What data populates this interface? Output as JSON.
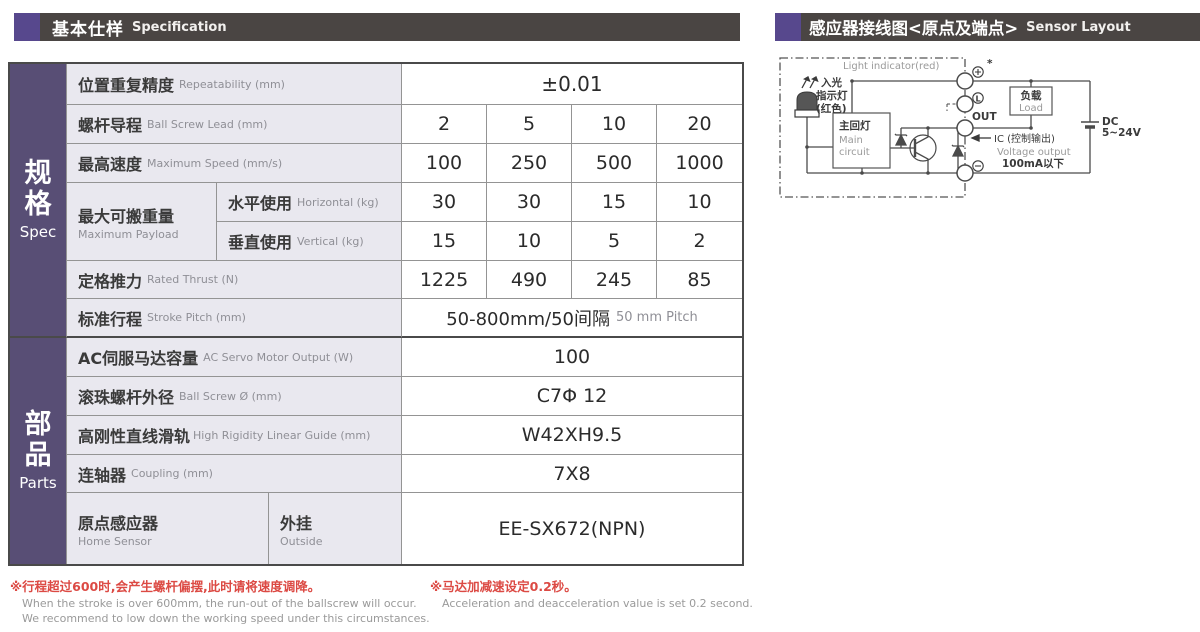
{
  "headers": {
    "left": {
      "zh": "基本仕样",
      "en": "Specification"
    },
    "right": {
      "zh": "感应器接线图<原点及端点>",
      "en": "Sensor Layout"
    }
  },
  "spec_table": {
    "sidebar": {
      "spec": {
        "zh1": "规",
        "zh2": "格",
        "en": "Spec"
      },
      "parts": {
        "zh1": "部",
        "zh2": "品",
        "en": "Parts"
      }
    },
    "rows": {
      "repeatability": {
        "zh": "位置重复精度",
        "en": "Repeatability (mm)",
        "value": "±0.01"
      },
      "ball_screw_lead": {
        "zh": "螺杆导程",
        "en": "Ball Screw Lead (mm)",
        "values": [
          "2",
          "5",
          "10",
          "20"
        ]
      },
      "max_speed": {
        "zh": "最高速度",
        "en": "Maximum Speed (mm/s)",
        "values": [
          "100",
          "250",
          "500",
          "1000"
        ]
      },
      "max_payload": {
        "zh": "最大可搬重量",
        "en": "Maximum Payload",
        "horizontal": {
          "zh": "水平使用",
          "en": "Horizontal (kg)",
          "values": [
            "30",
            "30",
            "15",
            "10"
          ]
        },
        "vertical": {
          "zh": "垂直使用",
          "en": "Vertical (kg)",
          "values": [
            "15",
            "10",
            "5",
            "2"
          ]
        }
      },
      "rated_thrust": {
        "zh": "定格推力",
        "en": "Rated Thrust (N)",
        "values": [
          "1225",
          "490",
          "245",
          "85"
        ]
      },
      "stroke_pitch": {
        "zh": "标准行程",
        "en": "Stroke Pitch (mm)",
        "value_zh": "50-800mm/50间隔",
        "value_en": "50 mm Pitch"
      },
      "servo_output": {
        "zh": "AC伺服马达容量",
        "en": "AC Servo Motor Output (W)",
        "value": "100"
      },
      "ball_screw_dia": {
        "zh": "滚珠螺杆外径",
        "en": "Ball Screw Ø (mm)",
        "value": "C7Φ 12"
      },
      "linear_guide": {
        "zh": "高刚性直线滑轨",
        "en": "High Rigidity Linear Guide (mm)",
        "value": "W42XH9.5"
      },
      "coupling": {
        "zh": "连轴器",
        "en": "Coupling (mm)",
        "value": "7X8"
      },
      "home_sensor": {
        "zh": "原点感应器",
        "en": "Home Sensor",
        "mount_zh": "外挂",
        "mount_en": "Outside",
        "value": "EE-SX672(NPN)"
      }
    }
  },
  "footnotes": {
    "left": {
      "zh": "※行程超过600时,会产生螺杆偏摆,此时请将速度调降。",
      "en1": "When the stroke is over 600mm, the run-out of the ballscrew will occur.",
      "en2": "We recommend to low down the working speed under this circumstances."
    },
    "right": {
      "zh": "※马达加减速设定0.2秒。",
      "en": "Acceleration and deacceleration value is set 0.2 second."
    }
  },
  "diagram": {
    "light_indicator_en": "Light indicator(red)",
    "led_zh1": "入光",
    "led_zh2": "指示灯",
    "led_zh3": "(红色)",
    "main_circuit_zh": "主回灯",
    "main_circuit_en1": "Main",
    "main_circuit_en2": "circuit",
    "terminal_plus": "+",
    "terminal_light": "L",
    "terminal_out": "OUT",
    "terminal_minus": "−",
    "asterisk": "*",
    "load_zh": "负载",
    "load_en": "Load",
    "ic_label": "IC (控制输出)",
    "voltage_output": "Voltage output",
    "current_limit": "100mA以下",
    "dc1": "DC",
    "dc2": "5~24V"
  },
  "colors": {
    "accent_purple": "#57488d",
    "header_bar": "#4a4543",
    "sidebar_purple": "#584e75",
    "label_bg": "#e9e8ef",
    "note_red": "#dc4a44",
    "grid_border": "#949494"
  }
}
